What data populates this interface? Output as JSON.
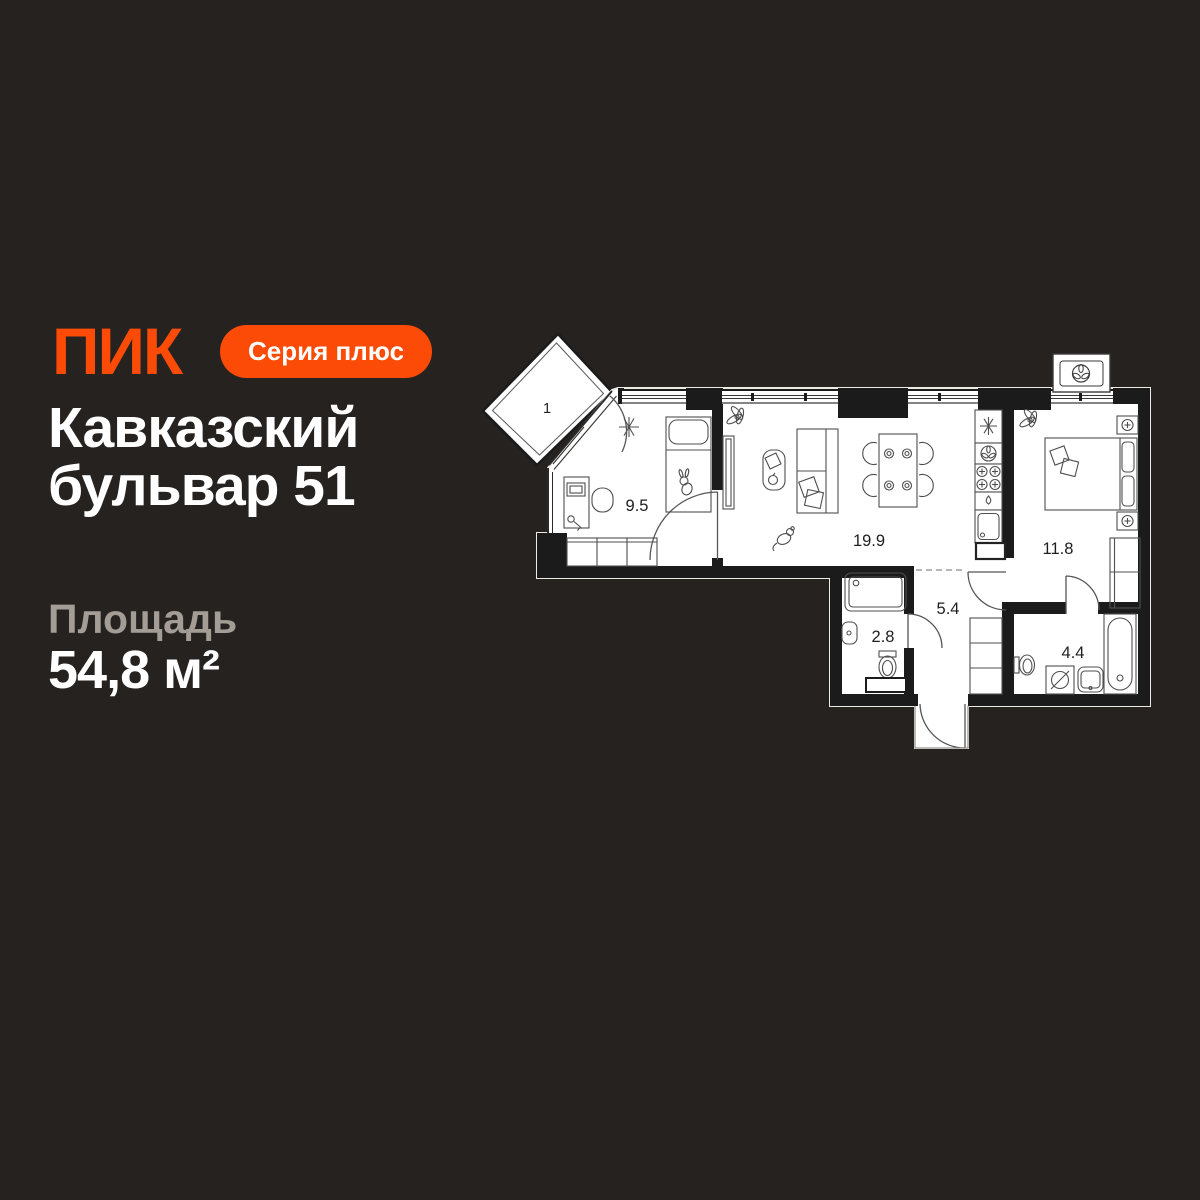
{
  "colors": {
    "background": "#252220",
    "brand_orange": "#FB4B06",
    "title_white": "#FFFFFF",
    "label_gray": "#A39D96",
    "plan_walls": "#1B1B1B"
  },
  "brand": {
    "logo": "ПИК",
    "badge": "Серия плюс"
  },
  "title": {
    "line1": "Кавказский",
    "line2": "бульвар 51"
  },
  "area": {
    "label": "Площадь",
    "value": "54,8 м²"
  },
  "plan": {
    "balcony": {
      "label": "1"
    },
    "rooms": [
      {
        "name": "child-bedroom",
        "area": "9.5"
      },
      {
        "name": "living-kitchen",
        "area": "19.9"
      },
      {
        "name": "master-bedroom",
        "area": "11.8"
      },
      {
        "name": "hallway",
        "area": "5.4"
      },
      {
        "name": "shower-wc",
        "area": "2.8"
      },
      {
        "name": "bathroom",
        "area": "4.4"
      }
    ]
  }
}
